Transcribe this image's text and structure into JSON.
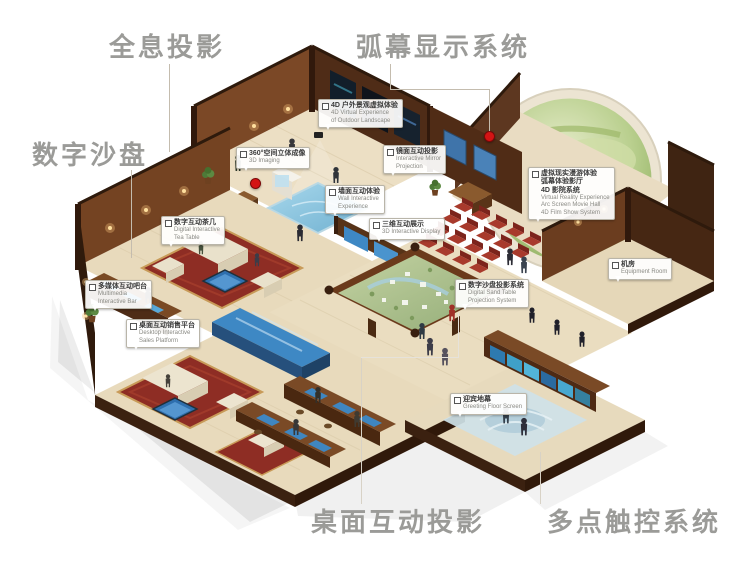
{
  "page": {
    "width": 741,
    "height": 563,
    "background": "#ffffff"
  },
  "colors": {
    "label_gray": "#9b9b98",
    "leader_line": "#c4bcae",
    "red_dot": "#d41414",
    "wall_wood_dark": "#4f2c17",
    "wall_wood_lit": "#7b4826",
    "floor_beige": "#eadcbf",
    "carpet_red": "#8e2d24",
    "screen_blue": "#3e88c4",
    "dome_green": "#8fb05e"
  },
  "outer_labels": {
    "holographic": {
      "text": "全息投影"
    },
    "arc_screen": {
      "text": "弧幕显示系统"
    },
    "digital_sandbox": {
      "text": "数字沙盘"
    },
    "desktop_projection": {
      "text": "桌面互动投影"
    },
    "multitouch": {
      "text": "多点触控系统"
    }
  },
  "callouts": [
    {
      "id": "4d-outdoor",
      "zh": "4D 户外景观虚拟体验",
      "en1": "4D Virtual Experience",
      "en2": "of Outdoor Landscape"
    },
    {
      "id": "360-imaging",
      "zh": "360°空间立体成像",
      "en1": "3D Imaging"
    },
    {
      "id": "mirror-projection",
      "zh": "镜面互动投影",
      "en1": "Interactive Mirror",
      "en2": "Projection"
    },
    {
      "id": "wall-interactive",
      "zh": "墙面互动体验",
      "en1": "Wall Interactive",
      "en2": "Experience"
    },
    {
      "id": "3d-display",
      "zh": "三维互动展示",
      "en1": "3D Interactive Display"
    },
    {
      "id": "dome-cinema",
      "zh1": "虚拟现实漫游体验",
      "zh2": "弧幕体验影厅",
      "zh3": "4D 影院系统",
      "en1": "Virtual Reality Experience",
      "en2": "Arc Screen Movie Hall",
      "en3": "4D Film Show System"
    },
    {
      "id": "equipment-room",
      "zh": "机房",
      "en1": "Equipment Room"
    },
    {
      "id": "sand-projection",
      "zh": "数字沙盘投影系统",
      "en1": "Digital Sand Table",
      "en2": "Projection System"
    },
    {
      "id": "greeting-floor",
      "zh": "迎宾地幕",
      "en1": "Greeting Floor Screen"
    },
    {
      "id": "tea-table",
      "zh": "数字互动茶几",
      "en1": "Digital Interactive",
      "en2": "Tea Table"
    },
    {
      "id": "media-bar",
      "zh": "多媒体互动吧台",
      "en1": "Multimedia",
      "en2": "Interactive Bar"
    },
    {
      "id": "sales-platform",
      "zh": "桌面互动销售平台",
      "en1": "Desktop Interactive",
      "en2": "Sales Platform"
    }
  ]
}
